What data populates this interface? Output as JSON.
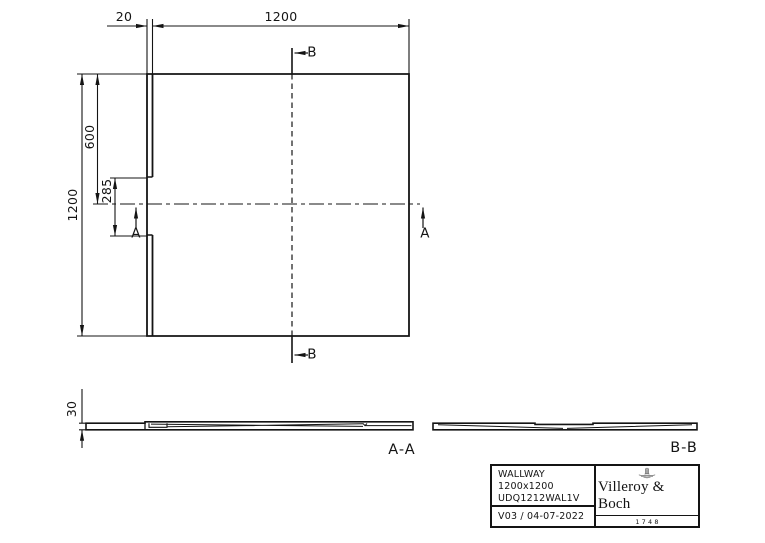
{
  "plan": {
    "dim_flange_width": "20",
    "dim_width": "1200",
    "dim_height": "1200",
    "dim_half_height": "600",
    "dim_gap": "285",
    "marker_a": "A",
    "marker_b": "B"
  },
  "sections": {
    "label_aa": "A-A",
    "label_bb": "B-B",
    "dim_thickness": "30"
  },
  "title_block": {
    "product_name": "WALLWAY",
    "product_size": "1200x1200",
    "product_code": "UDQ1212WAL1V",
    "revision": "V03 / 04-07-2022",
    "brand_name": "Villeroy & Boch",
    "brand_year": "1748"
  },
  "colors": {
    "line": "#141414",
    "background": "#ffffff"
  }
}
